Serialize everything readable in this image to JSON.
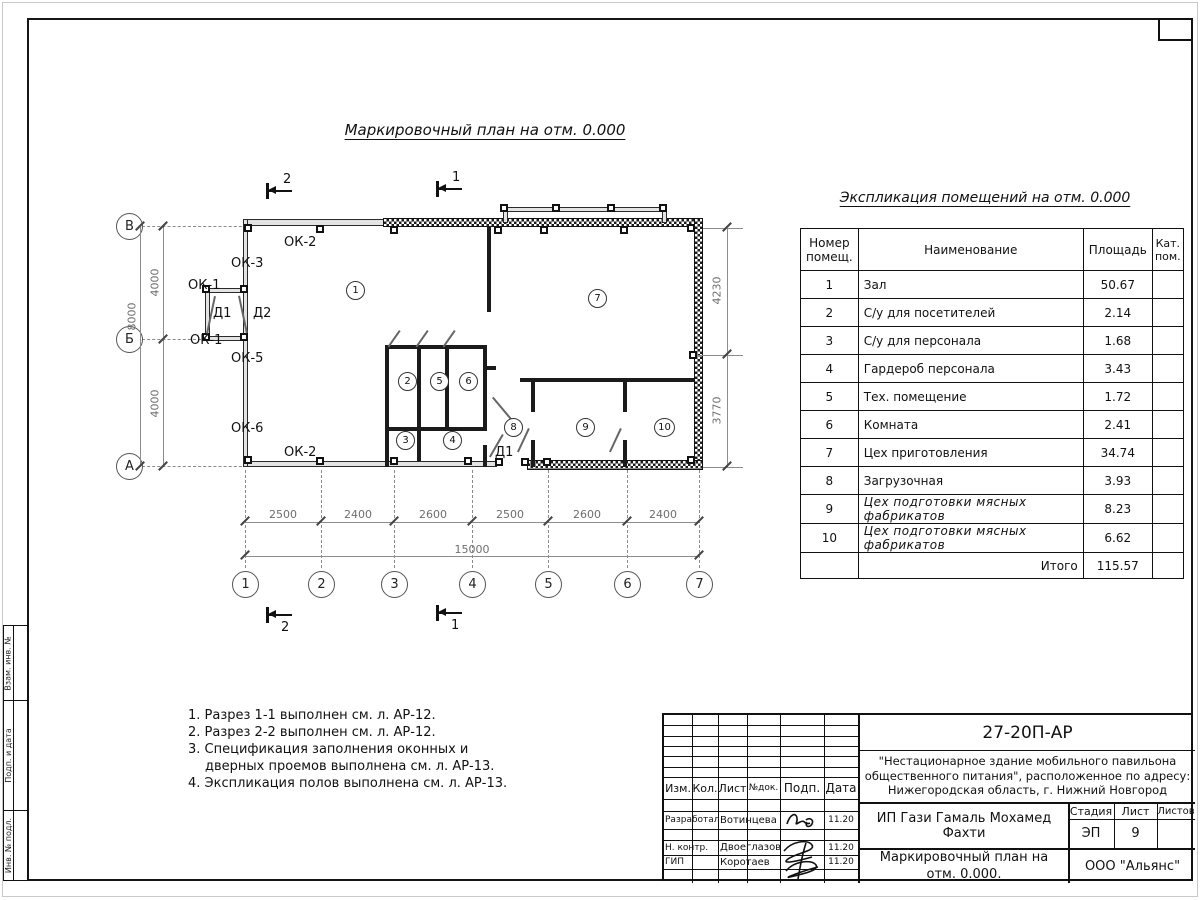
{
  "page": {
    "title": "Маркировочный план на отм. 0.000"
  },
  "plan": {
    "axes_left": [
      "В",
      "Б",
      "А"
    ],
    "axes_bottom": [
      "1",
      "2",
      "3",
      "4",
      "5",
      "6",
      "7"
    ],
    "dims_left": [
      "4000",
      "4000",
      "8000"
    ],
    "dims_right": [
      "4230",
      "3770"
    ],
    "dims_bottom": [
      "2500",
      "2400",
      "2600",
      "2500",
      "2600",
      "2400"
    ],
    "dim_total": "15000",
    "labels": [
      "ОК-2",
      "ОК-3",
      "ОК-1",
      "Д1",
      "Д2",
      "ОК-1",
      "ОК-5",
      "ОК-6",
      "ОК-2",
      "Д1"
    ],
    "rooms": [
      "1",
      "2",
      "3",
      "4",
      "5",
      "6",
      "7",
      "8",
      "9",
      "10"
    ],
    "section_1": "1",
    "section_2": "2"
  },
  "expl": {
    "title": "Экспликация помещений на отм. 0.000",
    "col_num": "Номер помещ.",
    "col_name": "Наименование",
    "col_area": "Площадь",
    "col_cat": "Кат. пом.",
    "rows": [
      {
        "num": "1",
        "name": "Зал",
        "area": "50.67"
      },
      {
        "num": "2",
        "name": "С/у для посетителей",
        "area": "2.14"
      },
      {
        "num": "3",
        "name": "С/у для персонала",
        "area": "1.68"
      },
      {
        "num": "4",
        "name": "Гардероб персонала",
        "area": "3.43"
      },
      {
        "num": "5",
        "name": "Тех. помещение",
        "area": "1.72"
      },
      {
        "num": "6",
        "name": "Комната",
        "area": "2.41"
      },
      {
        "num": "7",
        "name": "Цех приготовления",
        "area": "34.74"
      },
      {
        "num": "8",
        "name": "Загрузочная",
        "area": "3.93"
      },
      {
        "num": "9",
        "name": "Цех подготовки мясных фабрикатов",
        "area": "8.23"
      },
      {
        "num": "10",
        "name": "Цех подготовки мясных фабрикатов",
        "area": "6.62"
      }
    ],
    "total_label": "Итого",
    "total_area": "115.57"
  },
  "notes": [
    "1. Разрез 1-1 выполнен см. л. АР-12.",
    "2. Разрез 2-2 выполнен см. л. АР-12.",
    "3. Спецификация заполнения оконных и дверных проемов выполнена см. л. АР-13.",
    "4. Экспликация полов выполнена см. л. АР-13."
  ],
  "stamp": {
    "doc": "27-20П-АР",
    "project": "\"Нестационарное здание мобильного павильона общественного питания\", расположенное по адресу: Нижегородская область, г. Нижний Новгород",
    "col_izm": "Изм.",
    "col_kol": "Кол.",
    "col_list": "Лист",
    "col_ndok": "№док.",
    "col_podp": "Подп.",
    "col_data": "Дата",
    "r1_role": "Разработал",
    "r1_name": "Вотинцева",
    "r1_date": "11.20",
    "r2_role": "Н. контр.",
    "r2_name": "Двоеглазов",
    "r2_date": "11.20",
    "r3_role": "ГИП",
    "r3_name": "Коротаев",
    "r3_date": "11.20",
    "client": "ИП Гази Гамаль Мохамед Фахти",
    "stage_label": "Стадия",
    "list_label": "Лист",
    "listov_label": "Листов",
    "stage": "ЭП",
    "list_num": "9",
    "drawing": "Маркировочный план на отм. 0.000.",
    "company": "ООО \"Альянс\""
  },
  "side": {
    "a": "Взам. инв. №",
    "b": "Подп. и дата",
    "c": "Инв. № подл."
  }
}
